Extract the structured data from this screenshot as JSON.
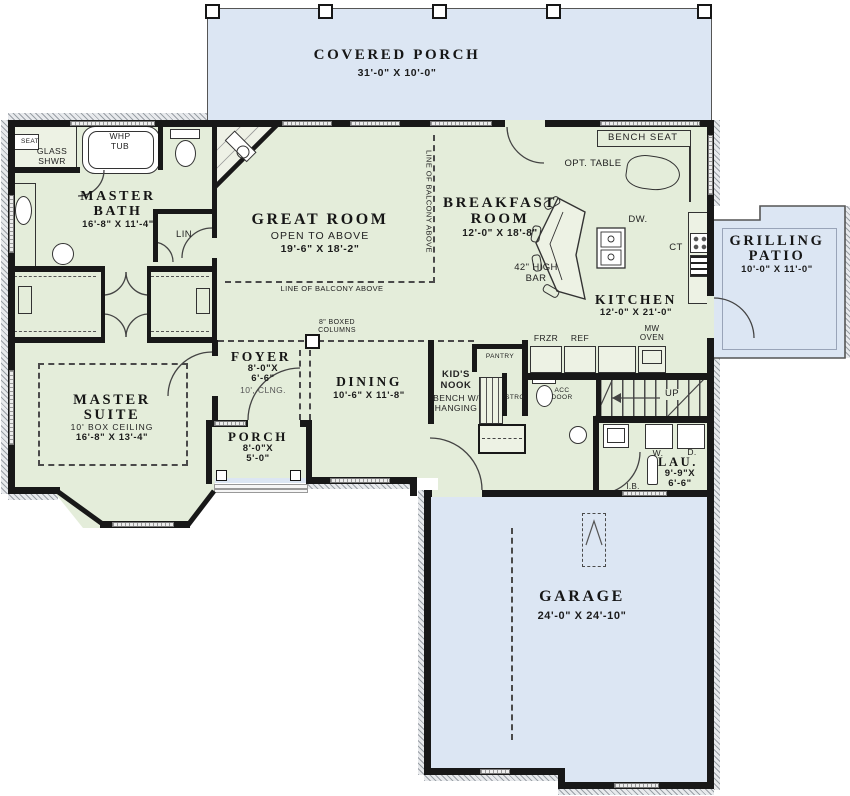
{
  "rooms": {
    "covered_porch": {
      "name": "COVERED PORCH",
      "dims": "31'-0\" X 10'-0\""
    },
    "master_bath": {
      "name": "MASTER\nBATH",
      "dims": "16'-8\" X 11'-4\""
    },
    "great_room": {
      "name": "GREAT ROOM",
      "note": "OPEN TO ABOVE",
      "dims": "19'-6\" X 18'-2\""
    },
    "breakfast_room": {
      "name": "BREAKFAST\nROOM",
      "dims": "12'-0\" X 18'-8\""
    },
    "kitchen": {
      "name": "KITCHEN",
      "dims": "12'-0\" X 21'-0\""
    },
    "grilling_patio": {
      "name": "GRILLING\nPATIO",
      "dims": "10'-0\" X 11'-0\""
    },
    "foyer": {
      "name": "FOYER",
      "dims": "8'-0\"X\n6'-6\"",
      "note": "10', CLNG."
    },
    "dining": {
      "name": "DINING",
      "dims": "10'-6\" X 11'-8\""
    },
    "kids_nook": {
      "name": "KID'S\nNOOK",
      "note": "BENCH W/\nHANGING"
    },
    "master_suite": {
      "name": "MASTER\nSUITE",
      "note": "10' BOX CEILING",
      "dims": "16'-8\" X 13'-4\""
    },
    "porch": {
      "name": "PORCH",
      "dims": "8'-0\"X\n5'-0\""
    },
    "laundry": {
      "name": "LAU.",
      "dims": "9'-9\"X\n6'-6\""
    },
    "garage": {
      "name": "GARAGE",
      "dims": "24'-0\" X 24'-10\""
    }
  },
  "labels": {
    "bench_seat": "BENCH SEAT",
    "opt_table": "OPT. TABLE",
    "dishwasher": "DW.",
    "cooktop": "CT",
    "high_bar": "42\" HIGH\nBAR",
    "freezer": "FRZR",
    "refrigerator": "REF",
    "microwave_oven": "MW\nOVEN",
    "pantry": "PANTRY",
    "storage": "STRG",
    "acc_door": "ACC\nDOOR",
    "stairs_up": "UP",
    "linen": "LIN",
    "whirlpool_tub": "WHP\nTUB",
    "shower_seat": "SEAT",
    "glass_shower": "GLASS\nSHWR",
    "washer": "W.",
    "dryer": "D.",
    "ironing_board": "I.B.",
    "boxed_columns": "8\" BOXED\nCOLUMNS",
    "balcony_line_h": "LINE OF BALCONY ABOVE",
    "balcony_line_v": "LINE OF BALCONY ABOVE"
  },
  "colors": {
    "room_fill": "#e4edda",
    "outdoor_fill": "#dce6f3",
    "wall": "#181818"
  }
}
